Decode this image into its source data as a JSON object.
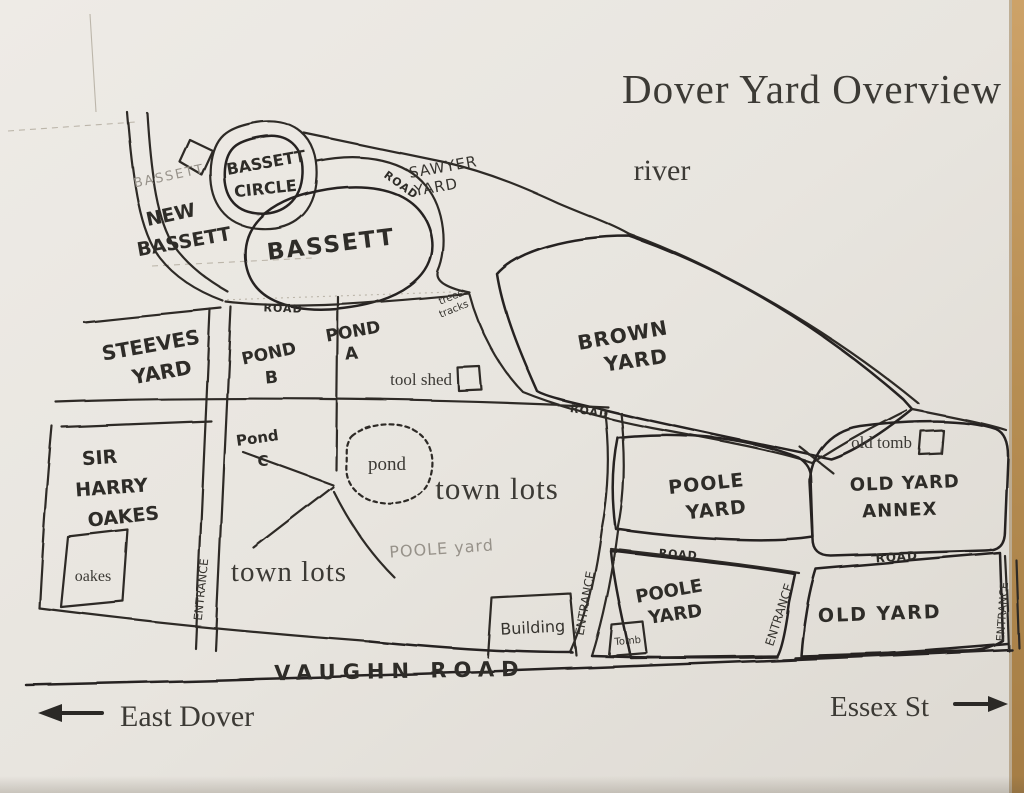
{
  "title": "Dover Yard Overview",
  "compass": {
    "west_label": "East Dover",
    "east_label": "Essex St"
  },
  "features": {
    "river": "river",
    "vaughn_road": "VAUGHN ROAD",
    "road": "ROAD",
    "entrance": "ENTRANCE",
    "tool_shed": "tool shed",
    "old_tomb": "old tomb",
    "tomb": "Tomb",
    "building": "Building",
    "pond": "pond",
    "town_lots": "town lots",
    "oakes_box": "oakes",
    "trees_tracks": [
      "trees",
      "tracks"
    ]
  },
  "yards": {
    "bassett_faint": "BASSETT",
    "bassett_circle": [
      "BASSETT",
      "CIRCLE"
    ],
    "new_bassett": [
      "NEW",
      "BASSETT"
    ],
    "bassett": "BASSETT",
    "sawyer": [
      "SAWYER",
      "YARD"
    ],
    "steeves": [
      "STEEVES",
      "YARD"
    ],
    "brown": [
      "BROWN",
      "YARD"
    ],
    "pond_a": [
      "POND",
      "A"
    ],
    "pond_b": [
      "POND",
      "B"
    ],
    "pond_c": [
      "Pond",
      "C"
    ],
    "sir_harry_oakes": [
      "SIR",
      "HARRY",
      "OAKES"
    ],
    "poole_pencil": "POOLE yard",
    "poole_upper": [
      "POOLE",
      "YARD"
    ],
    "poole_lower": [
      "POOLE",
      "YARD"
    ],
    "old_yard_annex": [
      "OLD YARD",
      "ANNEX"
    ],
    "old_yard": "OLD YARD"
  },
  "colors": {
    "paper": "#e9e6e0",
    "ink": "#2d2b27",
    "pencil": "#97928a",
    "photo_edge": "#b68d52"
  }
}
